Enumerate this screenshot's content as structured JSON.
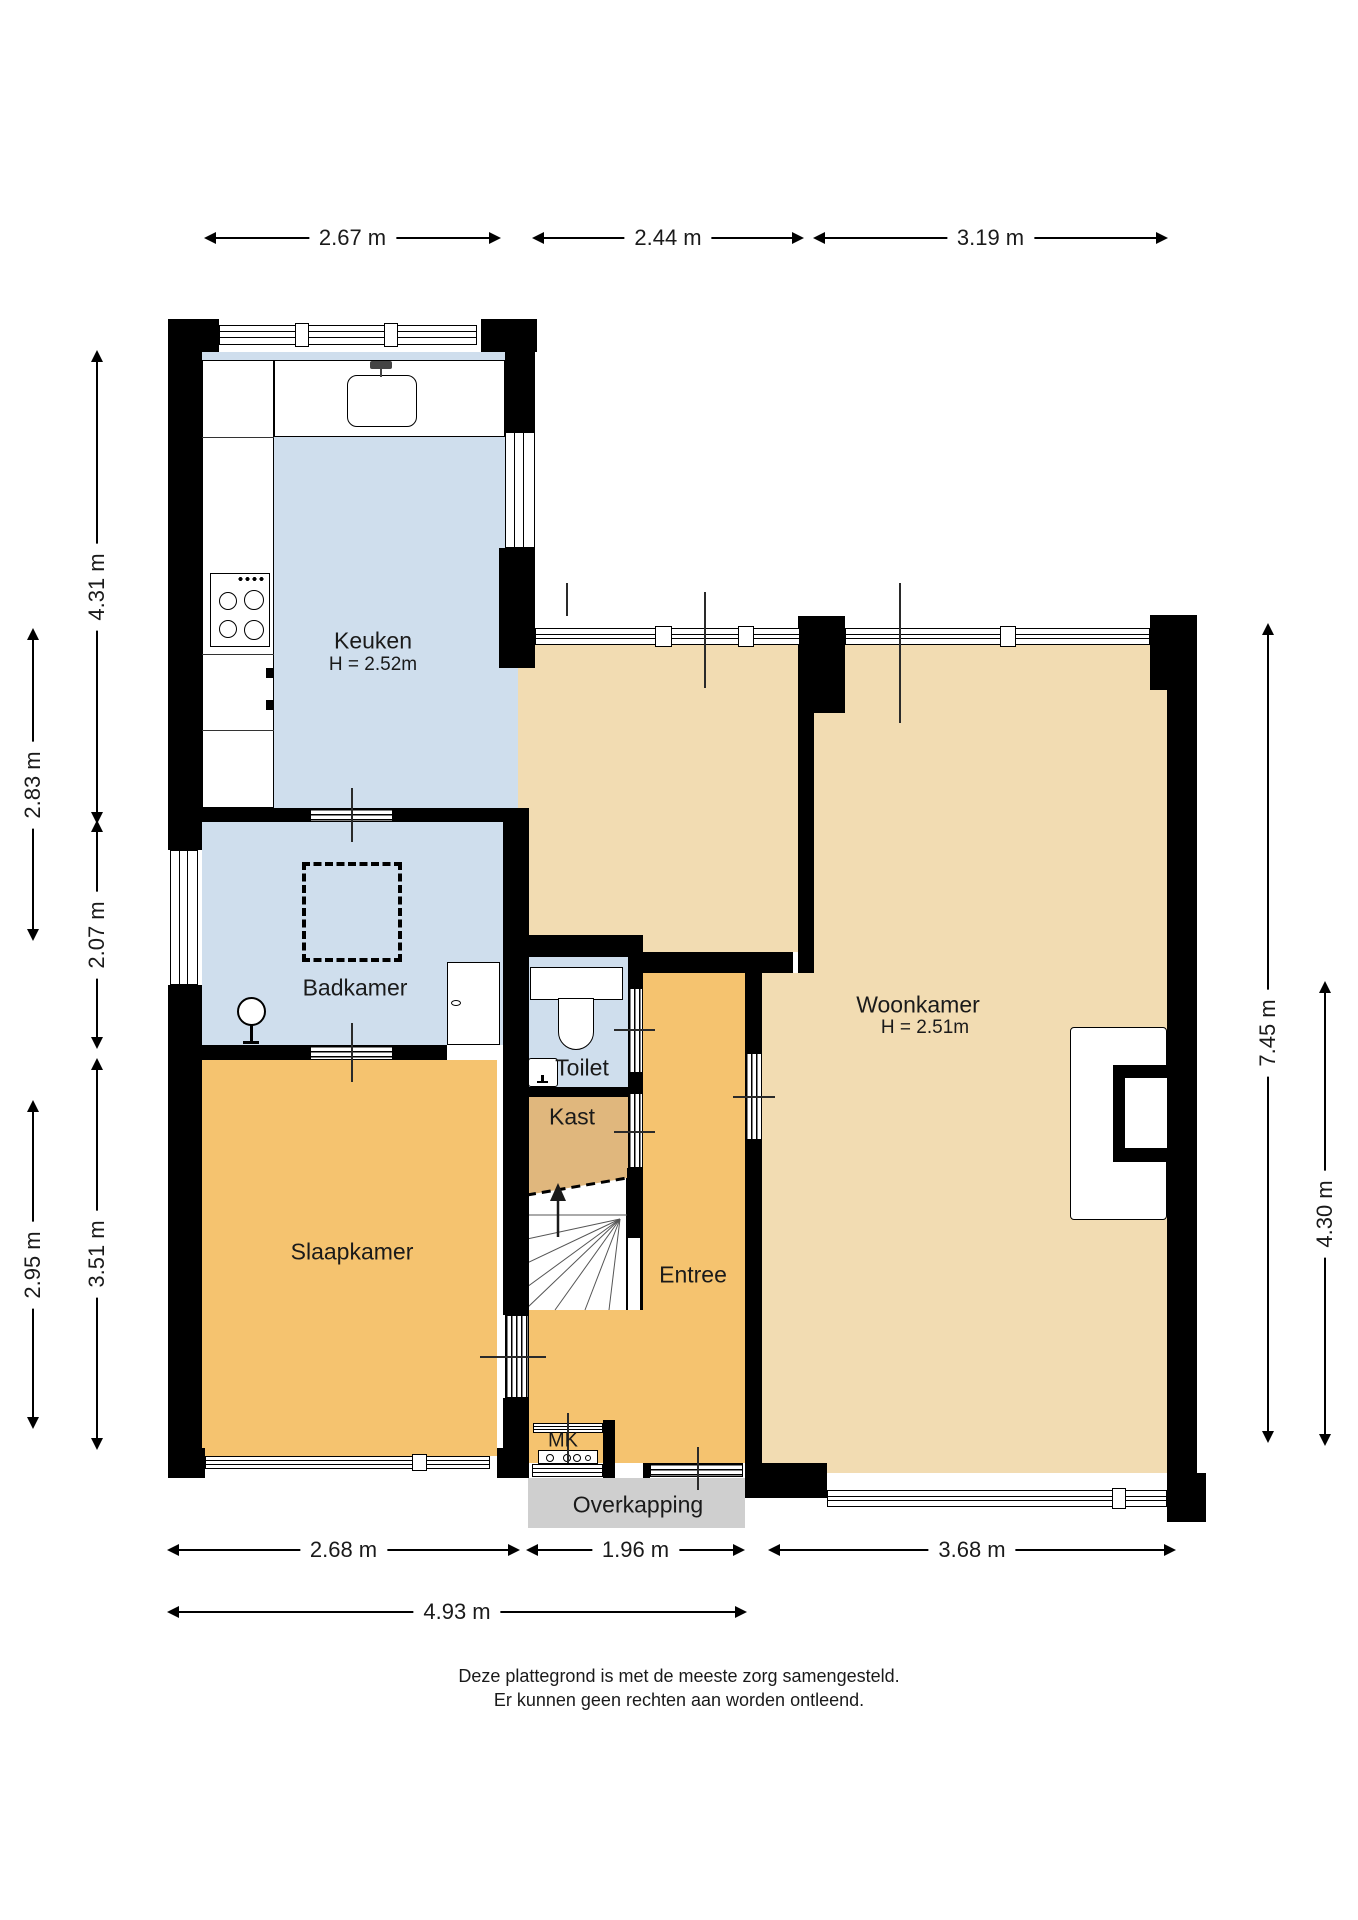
{
  "plan": {
    "rooms": {
      "keuken": {
        "name": "Keuken",
        "ceiling_height": "H = 2.52m"
      },
      "woonkamer": {
        "name": "Woonkamer",
        "ceiling_height": "H = 2.51m"
      },
      "badkamer": {
        "name": "Badkamer"
      },
      "toilet": {
        "name": "Toilet"
      },
      "kast": {
        "name": "Kast"
      },
      "slaapkamer": {
        "name": "Slaapkamer"
      },
      "entree": {
        "name": "Entree"
      },
      "meterkast": {
        "name": "MK"
      },
      "overkapping": {
        "name": "Overkapping"
      }
    },
    "dimensions": {
      "top": [
        {
          "label": "2.67 m"
        },
        {
          "label": "2.44 m"
        },
        {
          "label": "3.19 m"
        }
      ],
      "left_inner": [
        {
          "label": "4.31 m"
        },
        {
          "label": "2.07 m"
        },
        {
          "label": "3.51 m"
        }
      ],
      "left_outer": [
        {
          "label": "2.83 m"
        },
        {
          "label": "2.95 m"
        }
      ],
      "right": [
        {
          "label": "7.45 m"
        },
        {
          "label": "4.30 m"
        }
      ],
      "bottom": [
        {
          "label": "2.68 m"
        },
        {
          "label": "1.96 m"
        },
        {
          "label": "3.68 m"
        }
      ],
      "bottom_total": [
        {
          "label": "4.93 m"
        }
      ]
    },
    "footer": {
      "line1": "Deze plattegrond is met de meeste zorg samengesteld.",
      "line2": "Er kunnen geen rechten aan worden ontleend."
    },
    "colors": {
      "wet_room_floor": "#cfdeed",
      "living_room_floor": "#f2dcb2",
      "bedroom_hall_floor": "#f5c36f",
      "closet_floor": "#e0b77d",
      "canopy": "#cfcfcf",
      "wall": "#000000"
    }
  }
}
